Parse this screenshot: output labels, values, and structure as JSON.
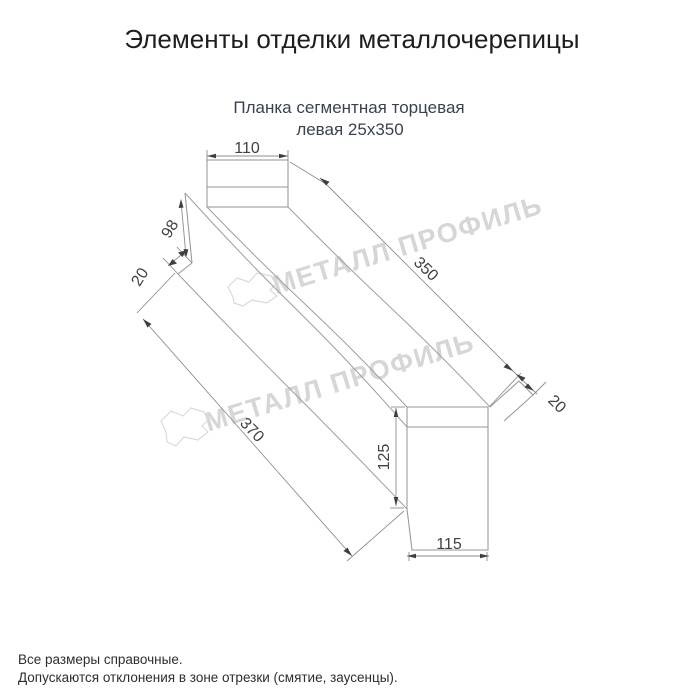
{
  "page": {
    "title": "Элементы отделки металлочерепицы",
    "subtitle_line1": "Планка сегментная торцевая",
    "subtitle_line2": "левая 25x350",
    "watermark": "МЕТАЛЛ ПРОФИЛЬ",
    "footer_line1": "Все размеры справочные.",
    "footer_line2": "Допускаются отклонения в зоне отрезки (смятие, заусенцы)."
  },
  "dims": {
    "top_width": "110",
    "left_height": "98",
    "left_flange": "20",
    "length_top": "350",
    "length_bottom": "370",
    "right_flange": "20",
    "right_height": "125",
    "right_width": "115"
  },
  "colors": {
    "line": "#9e9e9e",
    "dimension_text": "#414141",
    "subtitle_text": "#3a4252",
    "watermark": "#d6d6d6",
    "background": "#ffffff"
  }
}
